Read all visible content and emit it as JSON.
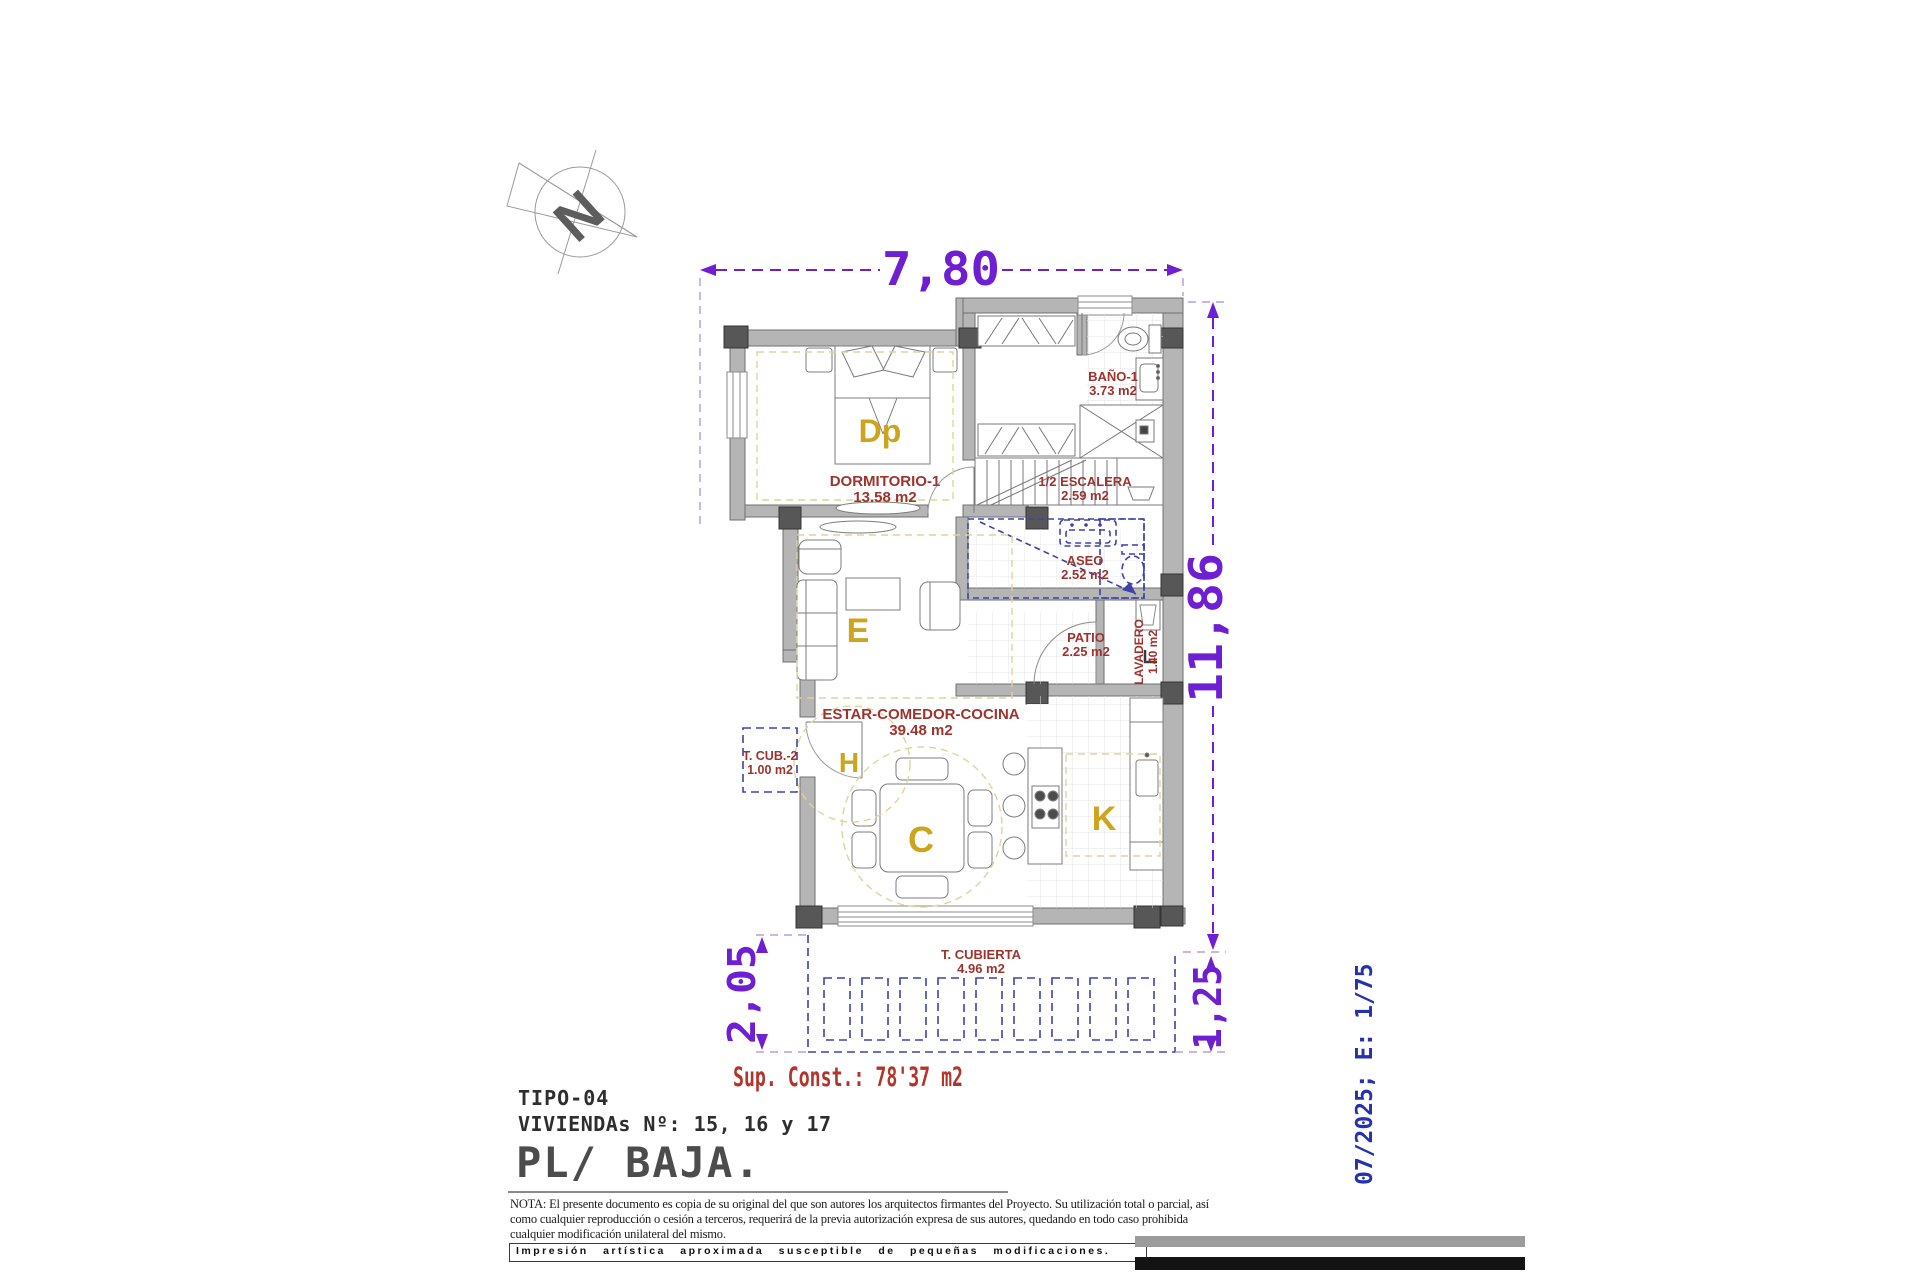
{
  "compass": {
    "north_letter": "N"
  },
  "dimensions": {
    "top_width": "7,80",
    "right_height": "11,86",
    "terrace_height_left": "2,05",
    "terrace_height_right": "1,25"
  },
  "rooms": {
    "dormitorio": {
      "name": "DORMITORIO-1",
      "area": "13.58 m2"
    },
    "bano": {
      "name": "BAÑO-1",
      "area": "3.73 m2"
    },
    "escalera": {
      "name": "1/2 ESCALERA",
      "area": "2.59 m2"
    },
    "aseo": {
      "name": "ASEO",
      "area": "2.52 m2"
    },
    "patio": {
      "name": "PATIO",
      "area": "2.25 m2"
    },
    "lavadero": {
      "name": "LAVADERO",
      "area": "1.40 m2"
    },
    "estar": {
      "name": "ESTAR-COMEDOR-COCINA",
      "area": "39.48 m2"
    },
    "tcub2": {
      "name": "T. CUB.-2",
      "area": "1.00 m2"
    },
    "tcubierta": {
      "name": "T. CUBIERTA",
      "area": "4.96 m2"
    }
  },
  "letters": {
    "dp": "Dp",
    "e": "E",
    "h": "H",
    "c": "C",
    "k": "K"
  },
  "summary": {
    "sup_const": "Sup. Const.: 78'37 m2"
  },
  "title_block": {
    "tipo": "TIPO-04",
    "viviendas": "VIVIENDAs Nº: 15, 16 y 17",
    "floor": "PL/ BAJA."
  },
  "side_note": {
    "date_scale": "07/2025; E: 1/75"
  },
  "nota": {
    "lines": [
      "NOTA: El presente documento es copia de su original del que son autores los arquitectos firmantes del Proyecto. Su utilización total o parcial, así",
      "como cualquier reproducción o cesión a terceros, requerirá  de la previa autorización expresa de sus autores, quedando en todo caso prohibida",
      "cualquier modificación unilateral del mismo."
    ]
  },
  "footer": {
    "box_text": "Impresión  artística  aproximada  susceptible  de  pequeñas  modificaciones."
  },
  "colors": {
    "dimension_purple": "#6e1fd2",
    "label_red": "#9e332e",
    "letter_yellow": "#cda41d",
    "dashed_navy": "#3d43a8",
    "side_blue": "#2433ad",
    "wall_gray": "#b5b5b5"
  }
}
